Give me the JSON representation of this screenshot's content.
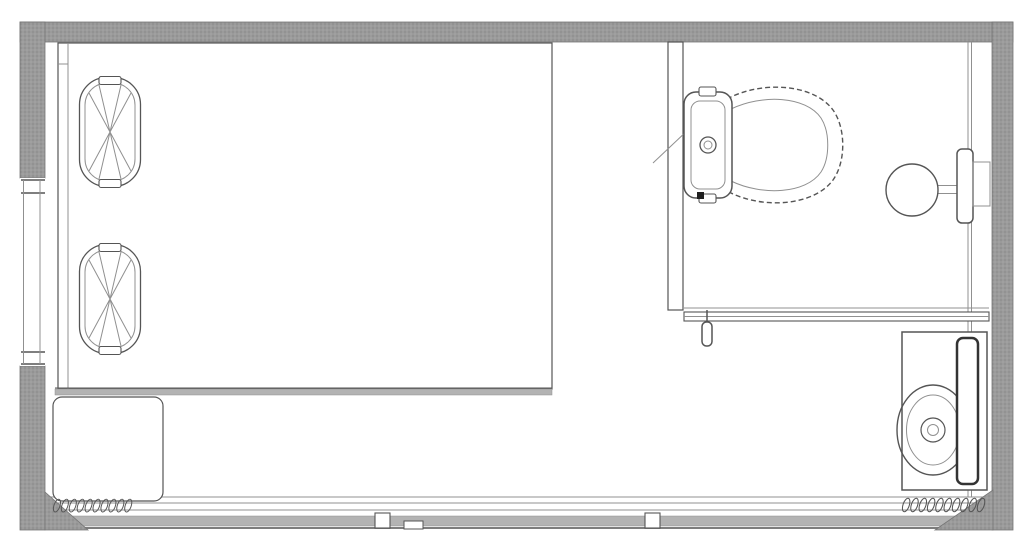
{
  "app": {
    "type": "architectural-floor-plan",
    "description": "CAD-style top-view floor plan of a rectangular room with a bed area and an en-suite bathroom"
  },
  "palette": {
    "background": "#ffffff",
    "wall_fill": "#9b9b9b",
    "wall_hatch_dark": "#868686",
    "wall_hatch_light": "#aeaeae",
    "wall_edge": "#757575",
    "line": "#555555",
    "line_soft": "#909090",
    "band": "#b3b3b3",
    "accent_dark": "#1f1f1f"
  },
  "floorplan": {
    "canvas": {
      "width": 1024,
      "height": 545
    },
    "rooms": [
      {
        "label": "Bedroom / living area"
      },
      {
        "label": "Bathroom"
      }
    ],
    "fixtures": [
      {
        "id": "bed",
        "label": "Double bed"
      },
      {
        "id": "pillow-top",
        "label": "Pillow"
      },
      {
        "id": "pillow-bottom",
        "label": "Pillow"
      },
      {
        "id": "nightstand",
        "label": "Bedside table"
      },
      {
        "id": "toilet",
        "label": "Toilet with tank"
      },
      {
        "id": "wash-basin",
        "label": "Wall-mounted round wash basin"
      },
      {
        "id": "washing-machine",
        "label": "Washing machine with round drum"
      },
      {
        "id": "window",
        "label": "Window in left wall"
      },
      {
        "id": "bathroom-sliding-door",
        "label": "Bathroom sliding door with pull handle"
      },
      {
        "id": "glass-sliding-wall",
        "label": "Bottom sliding glass wall with handles"
      },
      {
        "id": "coil-left",
        "label": "Coil / threshold symbol"
      },
      {
        "id": "coil-right",
        "label": "Coil / threshold symbol"
      },
      {
        "id": "bathroom-partition",
        "label": "Bathroom partition wall"
      }
    ]
  }
}
